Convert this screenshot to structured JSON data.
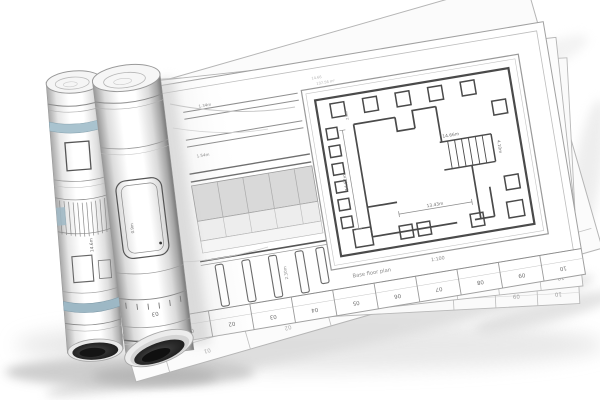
{
  "scene": {
    "description": "3D render of architectural blueprint drawings: two rolled-up plans resting on a fanned stack of large floor-plan sheets",
    "background": "#ffffff"
  },
  "colors": {
    "paper": "#ffffff",
    "ink": "#4a4a4a",
    "dim_text": "#777777",
    "accent_blue": "#a4bfcc",
    "shadow": "#cccccc",
    "tube_dark": "#1a1a1a"
  },
  "floor_plan": {
    "annotation_line1": "14.66",
    "annotation_line2": "137.56 m²",
    "dim_top_stair": "14.66m",
    "dim_stair_side": "4.10m",
    "dim_bottom": "13.43m",
    "dim_left": "14.52m",
    "dim_small_top": "2.6m",
    "title": "Base floor plan",
    "scale": "1:100"
  },
  "elevation": {
    "label_level1": "1.34m",
    "label_level2": "1.54m",
    "label_pile": "2.30m"
  },
  "ruler": {
    "marks": [
      "01",
      "02",
      "03",
      "04",
      "05",
      "06",
      "07",
      "08",
      "09",
      "10"
    ]
  },
  "back_sheet_b": {
    "marks": [
      "08",
      "09",
      "10"
    ]
  },
  "back_sheet_c": {
    "marks": [
      "09",
      "10"
    ]
  },
  "base_sheet": {
    "marks": [
      "01",
      "02"
    ]
  },
  "left_roll": {
    "dim_label": "14.6m"
  },
  "open_roll": {
    "dim_label": "0.9m",
    "ruler_mark": "03"
  }
}
